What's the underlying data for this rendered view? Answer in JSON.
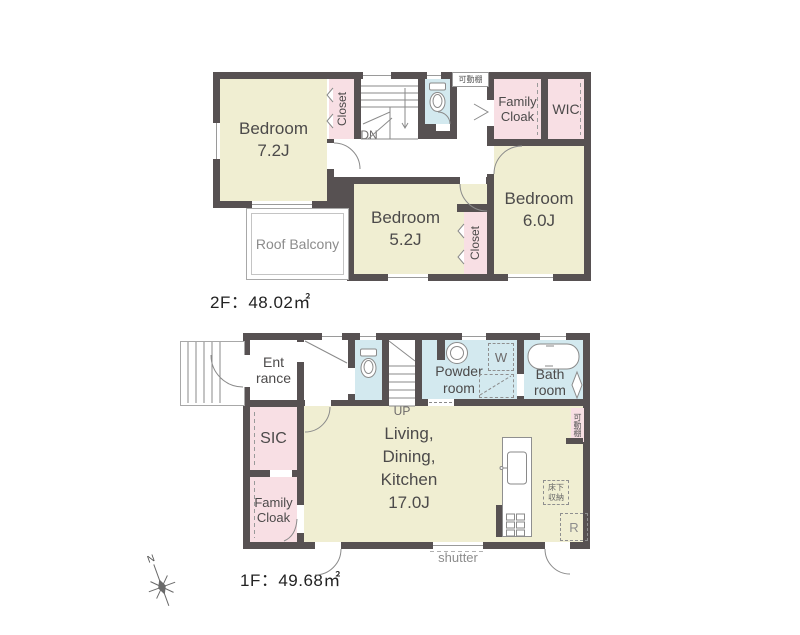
{
  "floor2": {
    "area_label": "2F：48.02㎡",
    "bedroom_72": "Bedroom\n7.2J",
    "bedroom_52": "Bedroom\n5.2J",
    "bedroom_60": "Bedroom\n6.0J",
    "closet_a": "Closet",
    "closet_b": "Closet",
    "family_cloak": "Family\nCloak",
    "wic": "WIC",
    "roof_balcony": "Roof Balcony",
    "stairs_label": "DN",
    "shelf_label": "可動棚"
  },
  "floor1": {
    "area_label": "1F：49.68㎡",
    "entrance": "Ent\nrance",
    "sic": "SIC",
    "family_cloak": "Family\nCloak",
    "ldk": "Living,\nDining,\nKitchen\n17.0J",
    "powder_room": "Powder\nroom",
    "bath_room": "Bath\nroom",
    "washer_label": "W",
    "fridge_label": "R",
    "floor_storage": "床下\n収納",
    "shelf_label": "可動棚",
    "stairs_label": "UP",
    "shutter_label": "shutter"
  },
  "compass": {
    "north": "N"
  },
  "colors": {
    "wall": "#575152",
    "bedroom_fill": "#f0eed2",
    "closet_fill": "#f8dfe4",
    "wet_area_fill": "#d3e9ef",
    "background": "#ffffff"
  }
}
